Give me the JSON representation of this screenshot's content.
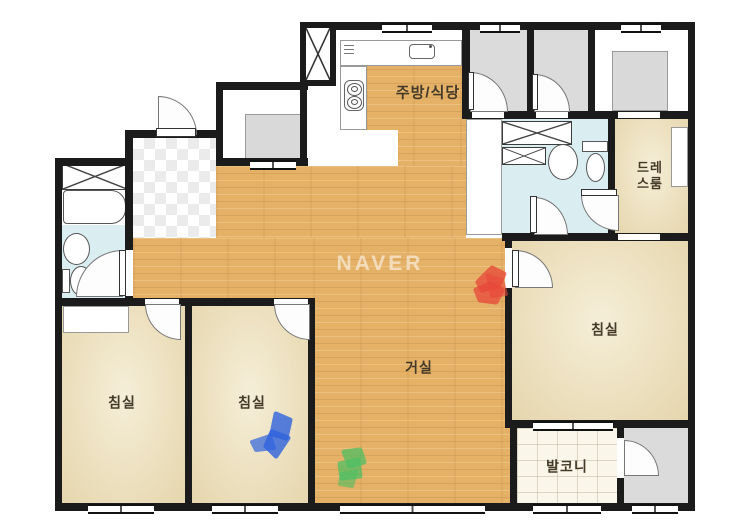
{
  "watermark": {
    "text": "NAVER"
  },
  "rooms": {
    "kitchen": {
      "label": "주방/식당"
    },
    "dressroom": {
      "label": "드레\n스룸"
    },
    "bedroom_left": {
      "label": "침실"
    },
    "bedroom_middle": {
      "label": "침실"
    },
    "bedroom_right": {
      "label": "침실"
    },
    "living": {
      "label": "거실"
    },
    "balcony": {
      "label": "발코니"
    }
  },
  "markers": {
    "red": "#e8473a",
    "blue": "#2f63dd",
    "green": "#4fbf63"
  },
  "palette": {
    "wall": "#1b1b1b",
    "wood": "#e4b167",
    "bedroom": "#ece0bd",
    "bathroom": "#daedf1",
    "gray_room": "#dbdbdb",
    "balcony_tile": "#faf6ea"
  }
}
